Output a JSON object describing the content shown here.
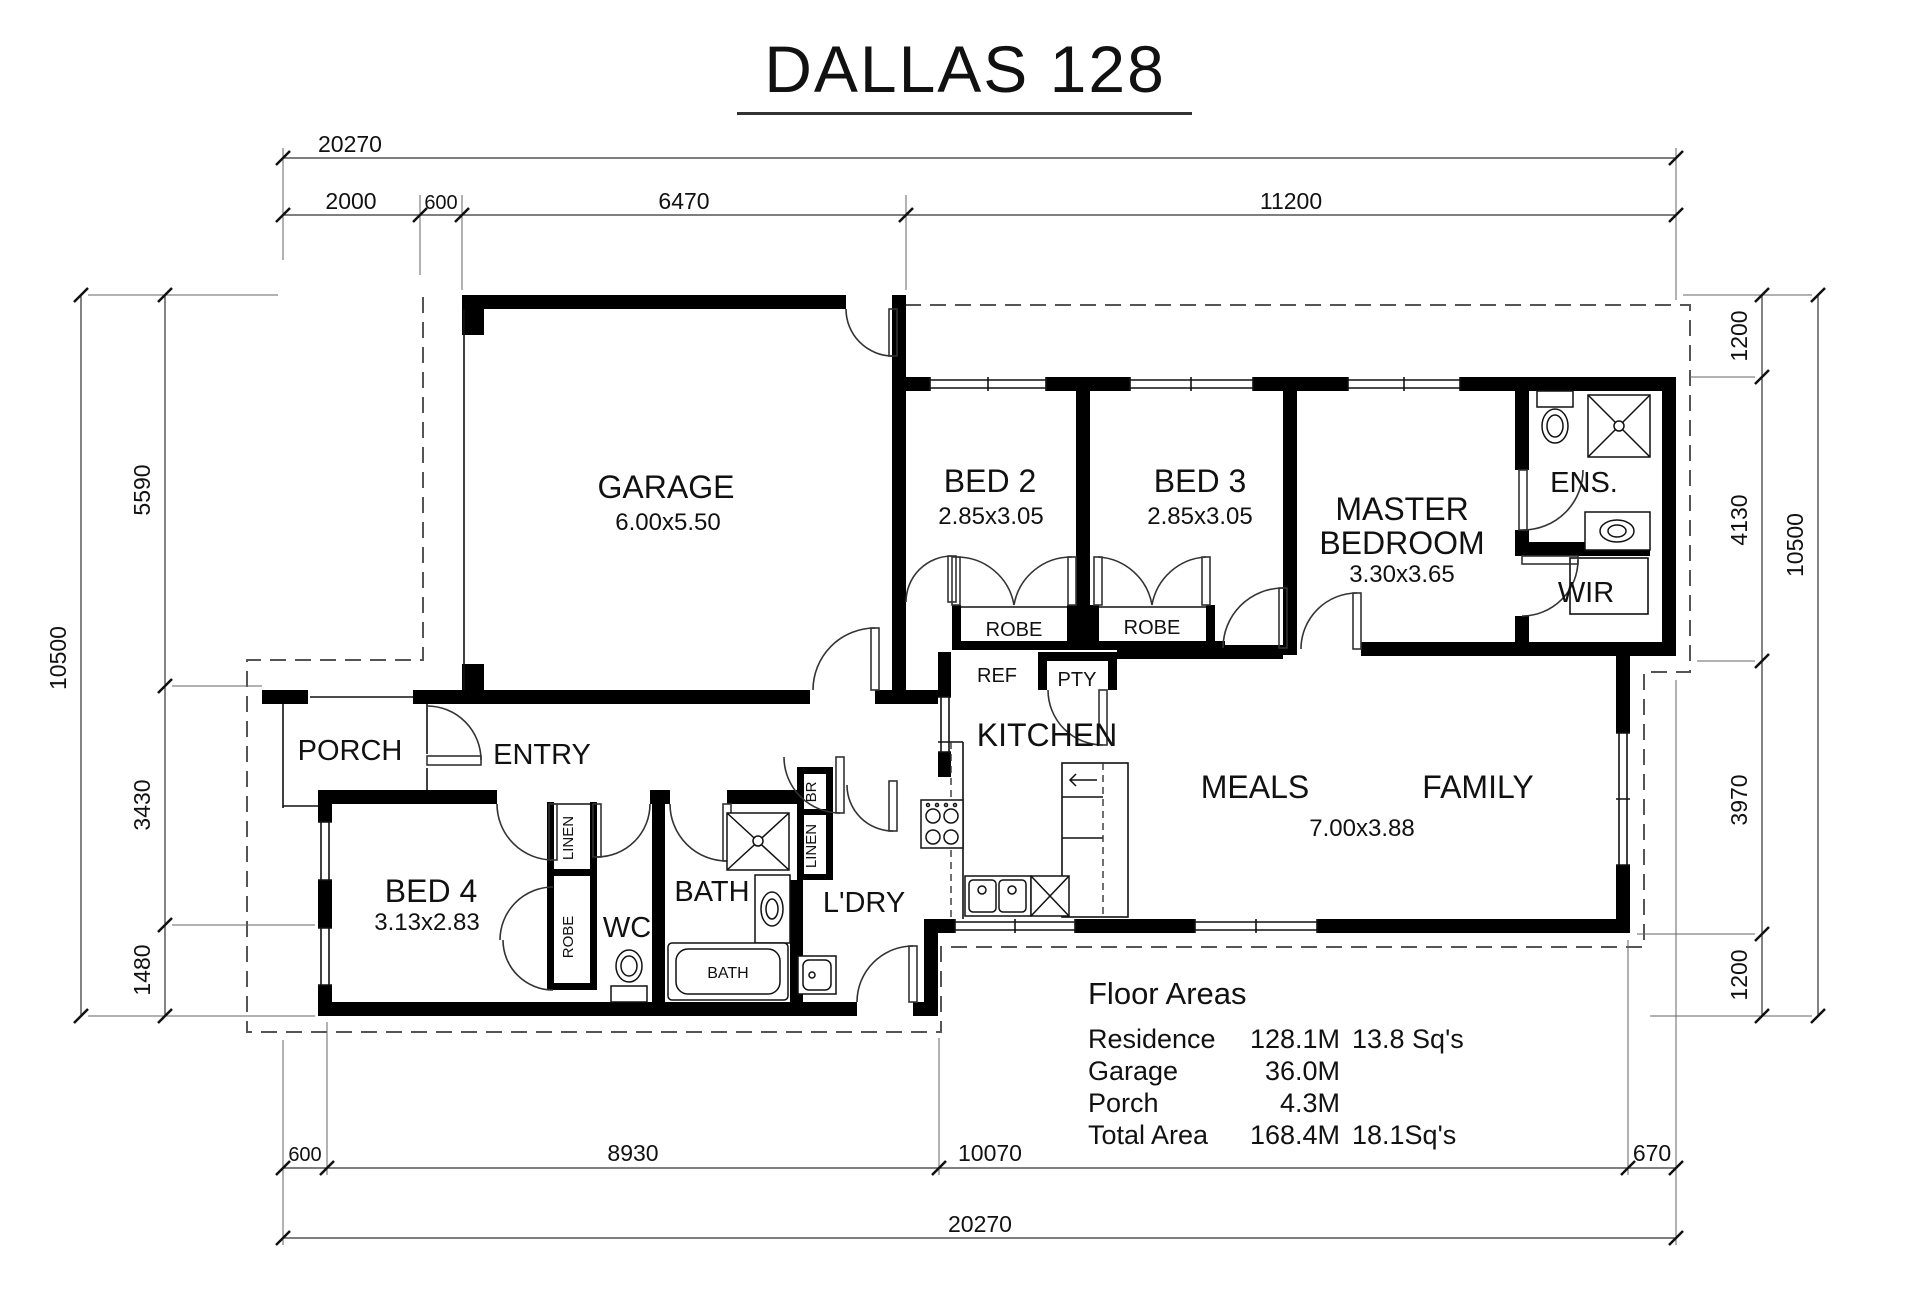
{
  "title": {
    "text": "DALLAS 128"
  },
  "colors": {
    "walls": "#000000",
    "ink": "#111111",
    "dashed_eaves": "#555555",
    "background": "#ffffff"
  },
  "dimensions": {
    "top": {
      "overall": "20270",
      "segments": [
        "2000",
        "600",
        "6470",
        "11200"
      ]
    },
    "bottom": {
      "overall": "20270",
      "segments": [
        "600",
        "8930",
        "10070",
        "670"
      ]
    },
    "left": {
      "overall": "10500",
      "segments": [
        "5590",
        "3430",
        "1480"
      ]
    },
    "right": {
      "overall": "10500",
      "segments": [
        "1200",
        "4130",
        "3970",
        "1200"
      ]
    }
  },
  "rooms": {
    "garage": {
      "name": "GARAGE",
      "size": "6.00x5.50"
    },
    "bed2": {
      "name": "BED 2",
      "size": "2.85x3.05"
    },
    "bed3": {
      "name": "BED 3",
      "size": "2.85x3.05"
    },
    "master": {
      "name_line1": "MASTER",
      "name_line2": "BEDROOM",
      "size": "3.30x3.65"
    },
    "ens": {
      "name": "ENS."
    },
    "wir": {
      "name": "WIR"
    },
    "kitchen": {
      "name": "KITCHEN"
    },
    "meals": {
      "name": "MEALS"
    },
    "family": {
      "name": "FAMILY"
    },
    "meals_family_size": "7.00x3.88",
    "porch": {
      "name": "PORCH"
    },
    "entry": {
      "name": "ENTRY"
    },
    "bed4": {
      "name": "BED 4",
      "size": "3.13x2.83"
    },
    "wc": {
      "name": "WC"
    },
    "bath": {
      "name": "BATH"
    },
    "ldry": {
      "name": "L'DRY"
    }
  },
  "storage": {
    "robe_bed2": "ROBE",
    "robe_bed3": "ROBE",
    "ref": "REF",
    "pantry": "PTY",
    "linen_hall": "LINEN",
    "robe_bed4": "ROBE",
    "broom": "BR",
    "linen_ldry": "LINEN"
  },
  "fixtures": {
    "bath_tub": "BATH"
  },
  "floor_areas": {
    "heading": "Floor Areas",
    "rows": [
      {
        "label": "Residence",
        "value": "128.1M",
        "extra": "13.8 Sq's"
      },
      {
        "label": "Garage",
        "value": "36.0M",
        "extra": ""
      },
      {
        "label": "Porch",
        "value": "4.3M",
        "extra": ""
      },
      {
        "label": "Total Area",
        "value": "168.4M",
        "extra": "18.1Sq's"
      }
    ]
  }
}
